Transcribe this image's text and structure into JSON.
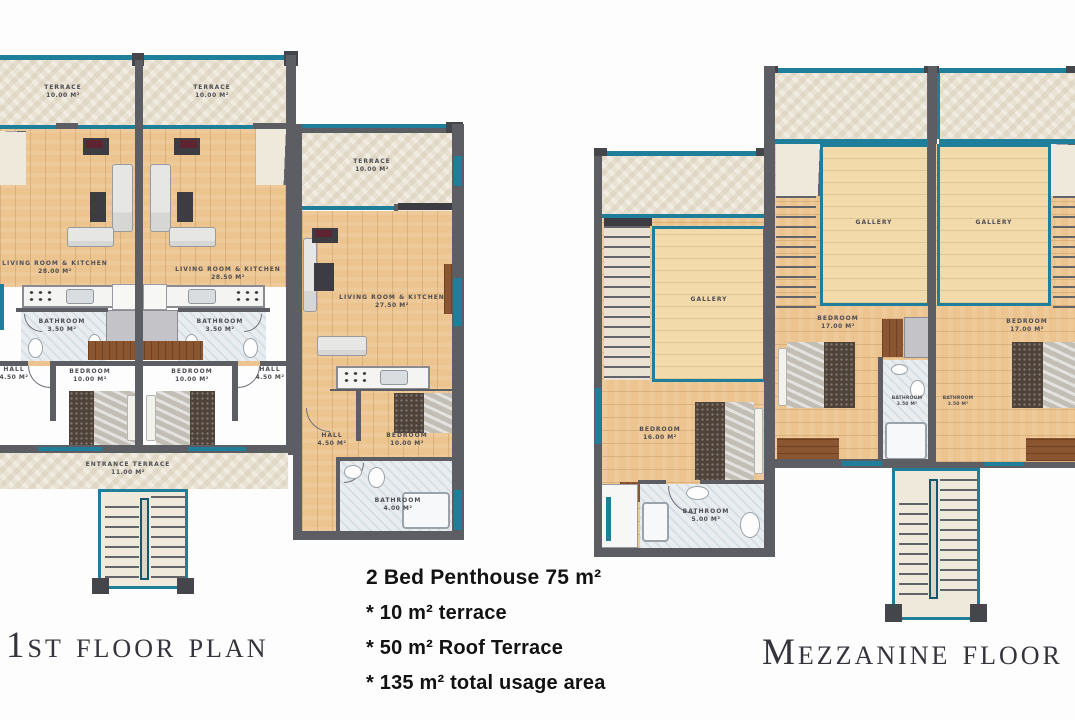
{
  "titles": {
    "first_floor": "1st floor plan",
    "mezzanine": "Mezzanine floor plan"
  },
  "summary": {
    "title": "2 Bed Penthouse  75 m²",
    "bullets": [
      "* 10 m² terrace",
      "* 50 m² Roof Terrace",
      "* 135 m² total usage area"
    ]
  },
  "first_floor": {
    "rooms": {
      "terrace_a": {
        "name": "Terrace",
        "area": "10.00 m²"
      },
      "terrace_b": {
        "name": "Terrace",
        "area": "10.00 m²"
      },
      "terrace_c": {
        "name": "Terrace",
        "area": "10.00 m²"
      },
      "living_a": {
        "name": "Living Room & Kitchen",
        "area": "28.00 m²"
      },
      "living_b": {
        "name": "Living Room & Kitchen",
        "area": "28.50 m²"
      },
      "living_c": {
        "name": "Living Room & Kitchen",
        "area": "27.50 m²"
      },
      "bathroom_a": {
        "name": "Bathroom",
        "area": "3.50 m²"
      },
      "bathroom_b": {
        "name": "Bathroom",
        "area": "3.50 m²"
      },
      "bathroom_c": {
        "name": "Bathroom",
        "area": "4.00 m²"
      },
      "bedroom_a": {
        "name": "Bedroom",
        "area": "10.00 m²"
      },
      "bedroom_b": {
        "name": "Bedroom",
        "area": "10.00 m²"
      },
      "bedroom_c": {
        "name": "Bedroom",
        "area": "10.00 m²"
      },
      "hall_a": {
        "name": "Hall",
        "area": "4.50 m²"
      },
      "hall_b": {
        "name": "Hall",
        "area": "4.50 m²"
      },
      "hall_c": {
        "name": "Hall",
        "area": "4.50 m²"
      },
      "entrance_terrace": {
        "name": "Entrance Terrace",
        "area": "11.00 m²"
      }
    }
  },
  "mezzanine": {
    "rooms": {
      "gallery_a": {
        "name": "Gallery"
      },
      "gallery_b": {
        "name": "Gallery"
      },
      "gallery_c": {
        "name": "Gallery"
      },
      "bedroom_a": {
        "name": "Bedroom",
        "area": "16.00 m²"
      },
      "bedroom_b": {
        "name": "Bedroom",
        "area": "17.00 m²"
      },
      "bedroom_c": {
        "name": "Bedroom",
        "area": "17.00 m²"
      },
      "bathroom_a": {
        "name": "Bathroom",
        "area": "5.00 m²"
      },
      "bathroom_b": {
        "name": "Bathroom",
        "area": "3.50 m²"
      },
      "bathroom_c": {
        "name": "Bathroom",
        "area": "3.50 m²"
      }
    }
  },
  "colors": {
    "wall": "#5d5d64",
    "window_teal": "#1f7e9a",
    "wood_floor": "#ecc48f",
    "terrace_stone": "#e9e2d2",
    "wardrobe_brown": "#8a5632"
  }
}
